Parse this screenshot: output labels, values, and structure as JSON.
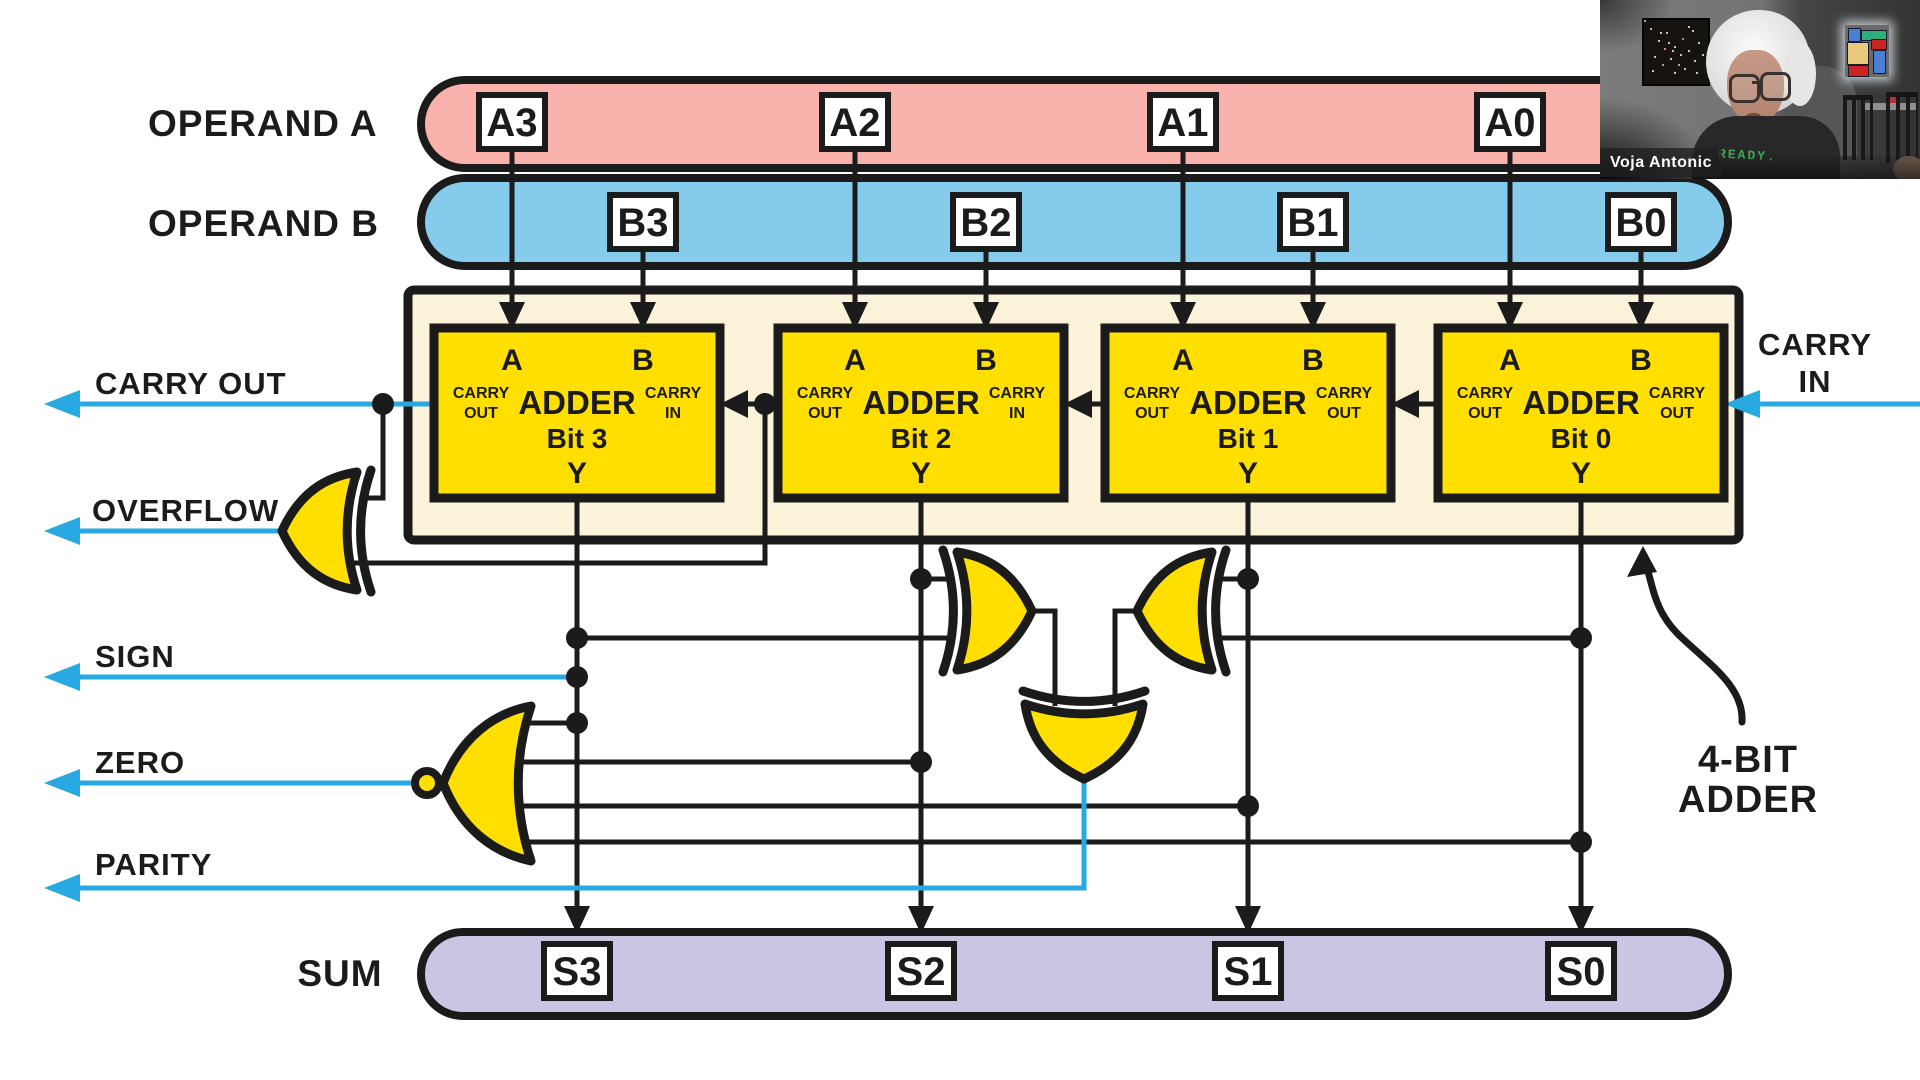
{
  "colors": {
    "operand_a_fill": "#f9b2ab",
    "operand_b_fill": "#85cbec",
    "sum_fill": "#cbc5e3",
    "adder_container_fill": "#faf3da",
    "adder_fill": "#ffdf00",
    "wire_blue": "#29a9e1",
    "outline": "#1b1b1b"
  },
  "operand_a": {
    "label": "OPERAND A",
    "bits": [
      "A3",
      "A2",
      "A1",
      "A0"
    ]
  },
  "operand_b": {
    "label": "OPERAND B",
    "bits": [
      "B3",
      "B2",
      "B1",
      "B0"
    ]
  },
  "sum": {
    "label": "SUM",
    "bits": [
      "S3",
      "S2",
      "S1",
      "S0"
    ]
  },
  "adders": [
    {
      "title": "ADDER",
      "bit": "Bit 3",
      "input_a": "A",
      "input_b": "B",
      "output": "Y",
      "left_label_line1": "CARRY",
      "left_label_line2": "OUT",
      "right_label_line1": "CARRY",
      "right_label_line2": "IN"
    },
    {
      "title": "ADDER",
      "bit": "Bit 2",
      "input_a": "A",
      "input_b": "B",
      "output": "Y",
      "left_label_line1": "CARRY",
      "left_label_line2": "OUT",
      "right_label_line1": "CARRY",
      "right_label_line2": "IN"
    },
    {
      "title": "ADDER",
      "bit": "Bit 1",
      "input_a": "A",
      "input_b": "B",
      "output": "Y",
      "left_label_line1": "CARRY",
      "left_label_line2": "OUT",
      "right_label_line1": "CARRY",
      "right_label_line2": "OUT"
    },
    {
      "title": "ADDER",
      "bit": "Bit 0",
      "input_a": "A",
      "input_b": "B",
      "output": "Y",
      "left_label_line1": "CARRY",
      "left_label_line2": "OUT",
      "right_label_line1": "CARRY",
      "right_label_line2": "OUT"
    }
  ],
  "signals": {
    "carry_out": "CARRY OUT",
    "overflow": "OVERFLOW",
    "sign": "SIGN",
    "zero": "ZERO",
    "parity": "PARITY",
    "carry_in_line1": "CARRY",
    "carry_in_line2": "IN"
  },
  "callout": {
    "line1": "4-BIT",
    "line2": "ADDER"
  },
  "webcam": {
    "name": "Voja Antonic",
    "shirt_text": "READY."
  }
}
